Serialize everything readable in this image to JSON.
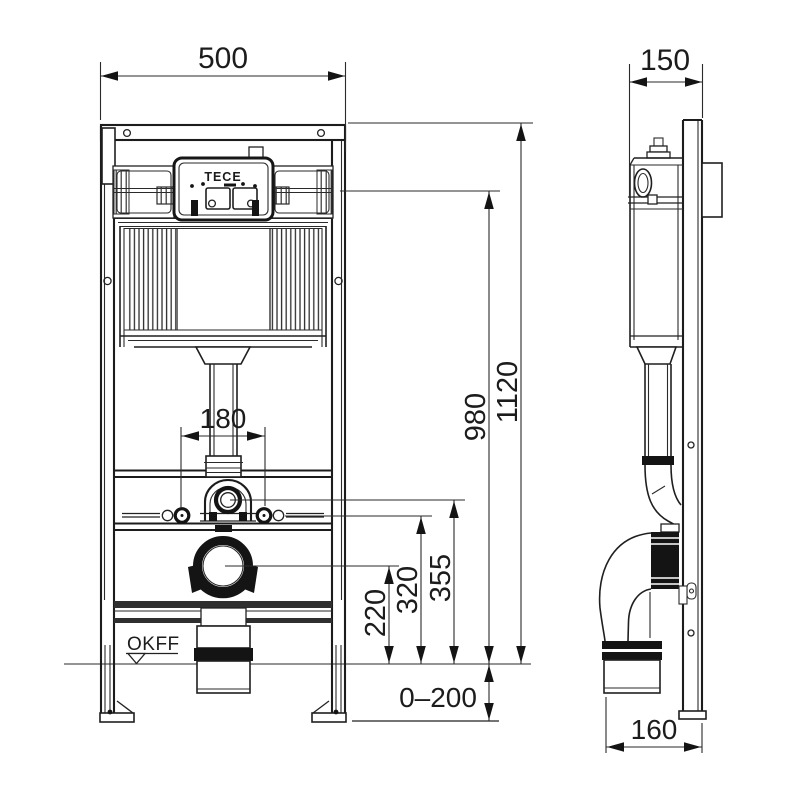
{
  "drawing": {
    "brand": "TECE",
    "floor_level_label": "OKFF",
    "dims": {
      "front_width": "500",
      "side_depth": "150",
      "total_height": "1120",
      "upper_ref_height": "980",
      "flush_bend_height": "355",
      "fixing_bolt_height": "320",
      "drain_center_height": "220",
      "fixing_bolt_spacing": "180",
      "leg_adjust_range": "0–200",
      "drain_wall_distance": "160"
    }
  }
}
